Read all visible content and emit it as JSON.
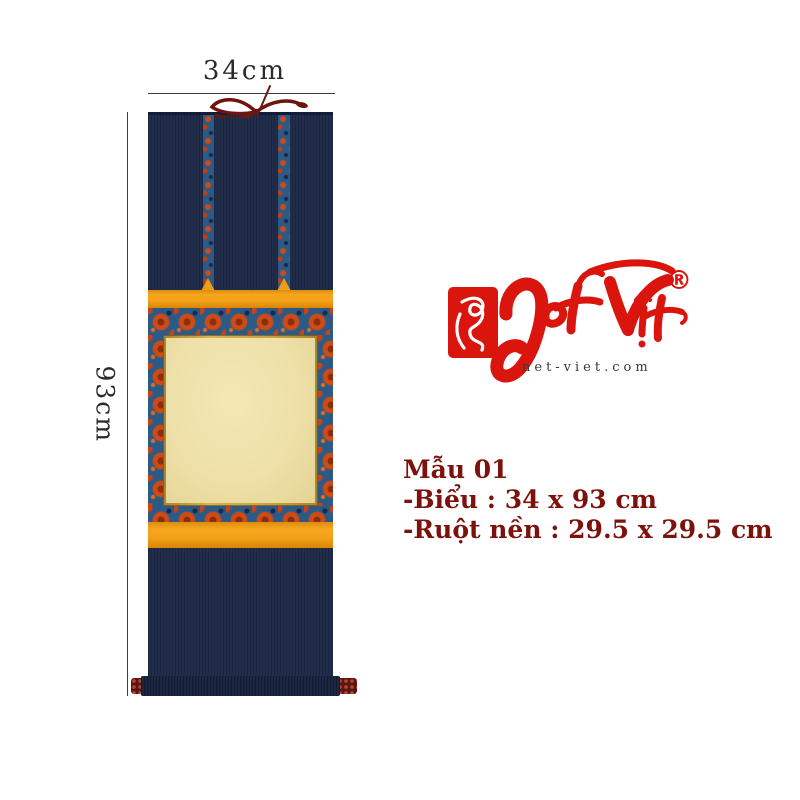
{
  "measurements": {
    "width_label": "34cm",
    "height_label": "93cm"
  },
  "logo": {
    "brand_name": "Net Việt",
    "registered_mark": "®",
    "website": "net-viet.com",
    "brand_color": "#d9150e"
  },
  "specs": {
    "model": "Mẫu 01",
    "size_line": "-Biểu : 34 x 93 cm",
    "core_line": "-Ruột nền : 29.5 x 29.5 cm",
    "text_color": "#7c120b"
  },
  "scroll": {
    "item": "hanging scroll",
    "colors": {
      "navy": "#1d2947",
      "orange_band": "#f2a01b",
      "brocade_blue": "#2d5a85",
      "brocade_red": "#cc4416",
      "panel_cream": "#efe2aa",
      "trim_gold": "#c09a3a",
      "ribbon": "#6d150e",
      "knob": "#5c150f"
    }
  }
}
